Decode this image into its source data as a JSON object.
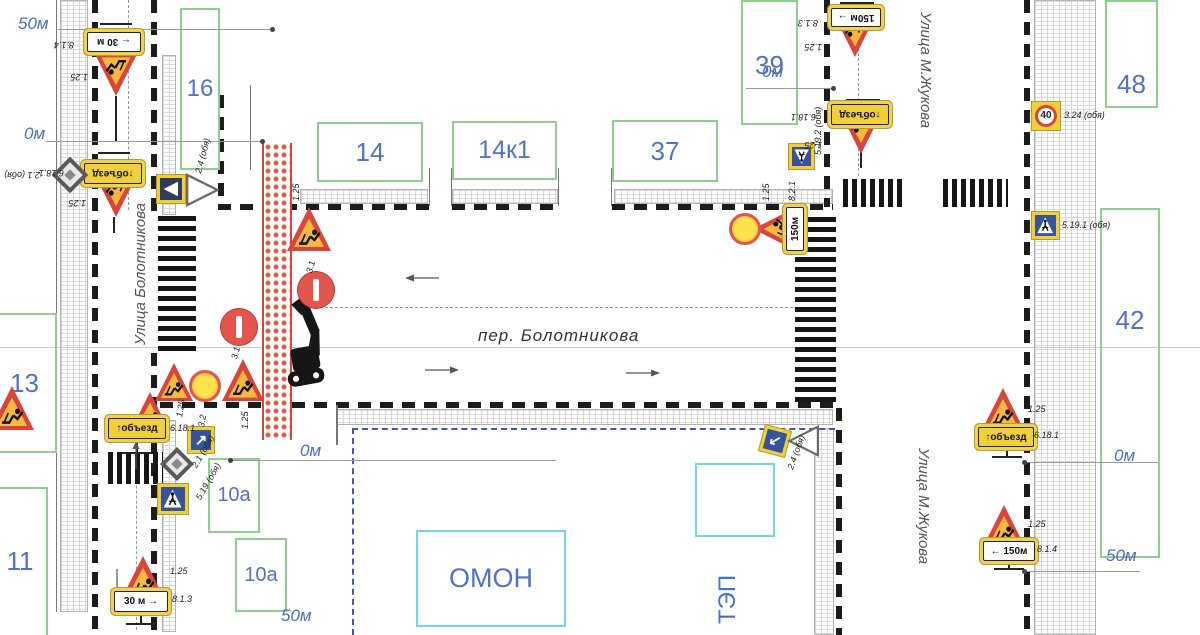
{
  "streets": {
    "left": "Улица Болотникова",
    "center": "пер. Болотникова",
    "right_top": "Улица М.Жукова",
    "right_bottom": "Улица М.Жукова"
  },
  "compounds": {
    "tep_label": "ТЭП"
  },
  "colors": {
    "accent_red": "#d9443b",
    "sign_yellow": "#f0cf3a",
    "building_green": "#8fce8f",
    "compound_cyan": "#74d4e8",
    "number_blue": "#5272c4",
    "marker_blue": "#4a6fc4"
  },
  "buildings": [
    {
      "label": "16",
      "x": 180,
      "y": 8,
      "w": 40,
      "h": 162,
      "fs": 24
    },
    {
      "label": "14",
      "x": 317,
      "y": 122,
      "w": 106,
      "h": 60,
      "fs": 26
    },
    {
      "label": "14к1",
      "x": 452,
      "y": 121,
      "w": 105,
      "h": 59,
      "fs": 25
    },
    {
      "label": "37",
      "x": 612,
      "y": 120,
      "w": 106,
      "h": 62,
      "fs": 26
    },
    {
      "label": "39",
      "x": 741,
      "y": 0,
      "w": 57,
      "h": 125,
      "fs": 26,
      "lp": 0.38
    },
    {
      "label": "48",
      "x": 1105,
      "y": 0,
      "w": 53,
      "h": 108,
      "fs": 26,
      "lp": 0.62
    },
    {
      "label": "42",
      "x": 1100,
      "y": 208,
      "w": 60,
      "h": 350,
      "fs": 26,
      "lp": 0.27
    },
    {
      "label": "13",
      "x": -8,
      "y": 313,
      "w": 65,
      "h": 140,
      "fs": 26
    },
    {
      "label": "11",
      "x": -8,
      "y": 487,
      "w": 56,
      "h": 150,
      "fs": 26,
      "lp": 0.38
    },
    {
      "label": "10а",
      "x": 208,
      "y": 458,
      "w": 52,
      "h": 75,
      "fs": 20
    },
    {
      "label": "10а",
      "x": 235,
      "y": 538,
      "w": 52,
      "h": 74,
      "fs": 20
    }
  ],
  "areas": [
    {
      "label": "ОМОН",
      "x": 416,
      "y": 530,
      "w": 150,
      "h": 97,
      "fs": 27
    },
    {
      "label": "",
      "x": 695,
      "y": 463,
      "w": 80,
      "h": 74,
      "fs": 0
    }
  ],
  "markers": [
    {
      "text": "50м",
      "x": 18,
      "y": 14,
      "line": [
        58,
        29,
        272,
        29
      ],
      "dot": [
        272,
        29
      ]
    },
    {
      "text": "0м",
      "x": 24,
      "y": 124,
      "line": [
        46,
        141,
        262,
        141
      ],
      "dot": [
        262,
        141
      ]
    },
    {
      "text": "0м",
      "x": 300,
      "y": 441,
      "line": [
        230,
        460,
        556,
        460
      ],
      "dot": [
        230,
        460
      ]
    },
    {
      "text": "0м",
      "x": 762,
      "y": 62,
      "line": [
        746,
        88,
        833,
        88
      ],
      "dot": [
        833,
        88
      ]
    },
    {
      "text": "0м",
      "x": 1114,
      "y": 446,
      "line": [
        1024,
        462,
        1158,
        462
      ],
      "dot": [
        1024,
        462
      ]
    },
    {
      "text": "50м",
      "x": 1106,
      "y": 546,
      "line": [
        1024,
        571,
        1140,
        571
      ],
      "dot": [
        1024,
        571
      ]
    },
    {
      "text": "50м",
      "x": 281,
      "y": 606,
      "line": null,
      "dot": null
    }
  ],
  "signs": [
    {
      "k": "tri",
      "x": 116,
      "y": 75,
      "s": 42,
      "r": 180
    },
    {
      "k": "tri",
      "x": 116,
      "y": 196,
      "s": 42,
      "r": 180
    },
    {
      "k": "tri",
      "x": 174,
      "y": 382,
      "s": 38,
      "r": 0
    },
    {
      "k": "tri",
      "x": 243,
      "y": 380,
      "s": 42,
      "r": 0
    },
    {
      "k": "tri",
      "x": 150,
      "y": 412,
      "s": 40,
      "r": 0
    },
    {
      "k": "tri",
      "x": 12,
      "y": 408,
      "s": 44,
      "r": 0
    },
    {
      "k": "tri",
      "x": 309,
      "y": 229,
      "s": 44,
      "r": 0
    },
    {
      "k": "tri",
      "x": 773,
      "y": 229,
      "s": 40,
      "r": -90
    },
    {
      "k": "tri",
      "x": 855,
      "y": 37,
      "s": 40,
      "r": 180
    },
    {
      "k": "tri",
      "x": 861,
      "y": 133,
      "s": 42,
      "r": 180
    },
    {
      "k": "tri",
      "x": 1003,
      "y": 409,
      "s": 42,
      "r": 0
    },
    {
      "k": "tri",
      "x": 1004,
      "y": 526,
      "s": 42,
      "r": 0
    },
    {
      "k": "tri",
      "x": 143,
      "y": 578,
      "s": 44,
      "r": 0
    },
    {
      "k": "noentry",
      "x": 239,
      "y": 327,
      "s": 36
    },
    {
      "k": "noentry",
      "x": 316,
      "y": 290,
      "s": 36
    },
    {
      "k": "signal",
      "x": 205,
      "y": 386,
      "s": 32
    },
    {
      "k": "signal",
      "x": 745,
      "y": 229,
      "s": 32
    },
    {
      "k": "plate",
      "x": 114,
      "y": 42,
      "w": 54,
      "h": 20,
      "r": 180,
      "text": "← 30 м",
      "bg": "w"
    },
    {
      "k": "plate",
      "x": 113,
      "y": 173,
      "w": 58,
      "h": 21,
      "r": 180,
      "text": "↑объезд",
      "bg": "y"
    },
    {
      "k": "plate",
      "x": 856,
      "y": 17,
      "w": 50,
      "h": 19,
      "r": 180,
      "text": "150м →",
      "bg": "w"
    },
    {
      "k": "plate",
      "x": 860,
      "y": 114,
      "w": 58,
      "h": 21,
      "r": 180,
      "text": "↑объезд",
      "bg": "y"
    },
    {
      "k": "plate",
      "x": 795,
      "y": 229,
      "w": 44,
      "h": 18,
      "r": -90,
      "text": "150м",
      "bg": "w"
    },
    {
      "k": "plate",
      "x": 137,
      "y": 428,
      "w": 58,
      "h": 21,
      "r": 0,
      "text": "↑объезд",
      "bg": "y"
    },
    {
      "k": "plate",
      "x": 141,
      "y": 601,
      "w": 54,
      "h": 21,
      "r": 0,
      "text": "30 м →",
      "bg": "w"
    },
    {
      "k": "plate",
      "x": 1006,
      "y": 437,
      "w": 56,
      "h": 20,
      "r": 0,
      "text": "↑объезд",
      "bg": "y"
    },
    {
      "k": "plate",
      "x": 1009,
      "y": 551,
      "w": 52,
      "h": 20,
      "r": 0,
      "text": "← 150м",
      "bg": "w"
    },
    {
      "k": "cross",
      "x": 173,
      "y": 499,
      "s": 32,
      "r": 0
    },
    {
      "k": "cross",
      "x": 801,
      "y": 156,
      "s": 27,
      "r": 180
    },
    {
      "k": "cross",
      "x": 1045,
      "y": 225,
      "s": 29,
      "r": 0
    },
    {
      "k": "s40",
      "x": 1046,
      "y": 116,
      "s": 30,
      "text": "40"
    },
    {
      "k": "diam",
      "x": 177,
      "y": 464,
      "s": 24
    },
    {
      "k": "diam",
      "x": 70,
      "y": 175,
      "s": 26
    },
    {
      "k": "arr",
      "x": 201,
      "y": 440,
      "s": 28,
      "r": 0
    },
    {
      "k": "arr",
      "x": 775,
      "y": 441,
      "s": 28,
      "r": 195
    },
    {
      "k": "gw",
      "x": 203,
      "y": 190,
      "s": 34,
      "r": 90
    },
    {
      "k": "gw",
      "x": 803,
      "y": 441,
      "s": 32,
      "r": -90
    },
    {
      "k": "gwf",
      "x": 171,
      "y": 189,
      "s": 30,
      "r": 0
    }
  ],
  "labels": [
    {
      "t": "8.1.4",
      "x": 74,
      "y": 40,
      "r": 180
    },
    {
      "t": "1.25",
      "x": 88,
      "y": 72,
      "r": 180
    },
    {
      "t": "2.1 (обя)",
      "x": 40,
      "y": 170,
      "r": 180
    },
    {
      "t": "6.18.1",
      "x": 64,
      "y": 168,
      "r": 180
    },
    {
      "t": "1.25",
      "x": 86,
      "y": 198,
      "r": 180
    },
    {
      "t": "2.4 (обя)",
      "x": 198,
      "y": 168,
      "r": -75
    },
    {
      "t": "1.25",
      "x": 296,
      "y": 196,
      "r": -90
    },
    {
      "t": "3.1",
      "x": 234,
      "y": 354,
      "r": -75
    },
    {
      "t": "3.1",
      "x": 309,
      "y": 268,
      "r": -75
    },
    {
      "t": "1.25",
      "x": 179,
      "y": 412,
      "r": -80
    },
    {
      "t": "3.2",
      "x": 201,
      "y": 422,
      "r": -80
    },
    {
      "t": "1.25",
      "x": 245,
      "y": 424,
      "r": -90
    },
    {
      "t": "6.18.1",
      "x": 170,
      "y": 423,
      "r": 0
    },
    {
      "t": "5.19 (обя)",
      "x": 198,
      "y": 494,
      "r": -60
    },
    {
      "t": "2.1 (обя)",
      "x": 194,
      "y": 462,
      "r": -60
    },
    {
      "t": "1.25",
      "x": 170,
      "y": 566,
      "r": 0
    },
    {
      "t": "8.1.3",
      "x": 172,
      "y": 594,
      "r": 0
    },
    {
      "t": "8.1.3",
      "x": 818,
      "y": 18,
      "r": 180
    },
    {
      "t": "1.25",
      "x": 822,
      "y": 42,
      "r": 180
    },
    {
      "t": "6.18.1",
      "x": 816,
      "y": 112,
      "r": 180
    },
    {
      "t": "1.25",
      "x": 822,
      "y": 140,
      "r": 180
    },
    {
      "t": "5.19.2 (обя)",
      "x": 818,
      "y": 150,
      "r": -90
    },
    {
      "t": "1.25",
      "x": 766,
      "y": 196,
      "r": -90
    },
    {
      "t": "8.2.1",
      "x": 792,
      "y": 196,
      "r": -90
    },
    {
      "t": "3.24 (обя)",
      "x": 1064,
      "y": 110,
      "r": 0
    },
    {
      "t": "5.19.1 (обя)",
      "x": 1062,
      "y": 220,
      "r": 0
    },
    {
      "t": "1.25",
      "x": 1028,
      "y": 404,
      "r": 0
    },
    {
      "t": "6.18.1",
      "x": 1034,
      "y": 430,
      "r": 0
    },
    {
      "t": "1.25",
      "x": 1028,
      "y": 519,
      "r": 0
    },
    {
      "t": "8.1.4",
      "x": 1037,
      "y": 544,
      "r": 0
    },
    {
      "t": "2.4 (обя)",
      "x": 790,
      "y": 464,
      "r": -70
    }
  ],
  "zebras": [
    {
      "x": 158,
      "y": 216,
      "w": 38,
      "h": 138,
      "dir": "h"
    },
    {
      "x": 795,
      "y": 217,
      "w": 41,
      "h": 185,
      "dir": "h"
    },
    {
      "x": 108,
      "y": 452,
      "w": 55,
      "h": 32,
      "dir": "v"
    },
    {
      "x": 843,
      "y": 179,
      "w": 63,
      "h": 28,
      "dir": "v"
    },
    {
      "x": 943,
      "y": 179,
      "w": 65,
      "h": 28,
      "dir": "v"
    }
  ],
  "edges": [
    {
      "x": 92,
      "y": 0,
      "len": 635,
      "dir": "v"
    },
    {
      "x": 151,
      "y": 0,
      "len": 217,
      "dir": "v"
    },
    {
      "x": 151,
      "y": 353,
      "len": 282,
      "dir": "v"
    },
    {
      "x": 218,
      "y": 95,
      "len": 112,
      "dir": "v"
    },
    {
      "x": 218,
      "y": 204,
      "len": 212,
      "dir": "h"
    },
    {
      "x": 452,
      "y": 204,
      "len": 106,
      "dir": "h"
    },
    {
      "x": 612,
      "y": 204,
      "len": 221,
      "dir": "h"
    },
    {
      "x": 160,
      "y": 402,
      "len": 675,
      "dir": "h"
    },
    {
      "x": 824,
      "y": 0,
      "len": 207,
      "dir": "v"
    },
    {
      "x": 1024,
      "y": 0,
      "len": 635,
      "dir": "v"
    },
    {
      "x": 836,
      "y": 408,
      "len": 227,
      "dir": "v"
    }
  ],
  "hatches": [
    {
      "x": 60,
      "y": 0,
      "w": 28,
      "h": 612
    },
    {
      "x": 162,
      "y": 55,
      "w": 14,
      "h": 160
    },
    {
      "x": 300,
      "y": 189,
      "w": 128,
      "h": 15
    },
    {
      "x": 452,
      "y": 189,
      "w": 106,
      "h": 15
    },
    {
      "x": 614,
      "y": 189,
      "w": 219,
      "h": 15
    },
    {
      "x": 336,
      "y": 409,
      "w": 497,
      "h": 16
    },
    {
      "x": 1034,
      "y": 0,
      "w": 62,
      "h": 635
    },
    {
      "x": 814,
      "y": 428,
      "w": 20,
      "h": 207
    },
    {
      "x": 162,
      "y": 420,
      "w": 14,
      "h": 212
    }
  ],
  "guides": [
    {
      "x": 128,
      "y": 0,
      "len": 210,
      "dir": "v"
    },
    {
      "x": 136,
      "y": 430,
      "len": 200,
      "dir": "v"
    },
    {
      "x": 300,
      "y": 307,
      "len": 533,
      "dir": "h"
    },
    {
      "x": 858,
      "y": 8,
      "len": 168,
      "dir": "v"
    }
  ],
  "fences": [
    {
      "x": 352,
      "y": 428,
      "len": 483,
      "dir": "h"
    },
    {
      "x": 352,
      "y": 428,
      "len": 207,
      "dir": "v"
    }
  ],
  "walls": [
    {
      "x": 56,
      "y": 0,
      "w": 1,
      "h": 612
    },
    {
      "x": 250,
      "y": 85,
      "w": 1,
      "h": 85
    },
    {
      "x": 429,
      "y": 168,
      "w": 1,
      "h": 38
    },
    {
      "x": 451,
      "y": 168,
      "w": 1,
      "h": 38
    },
    {
      "x": 558,
      "y": 168,
      "w": 1,
      "h": 38
    },
    {
      "x": 611,
      "y": 168,
      "w": 1,
      "h": 38
    },
    {
      "x": 336,
      "y": 405,
      "w": 2,
      "h": 40
    }
  ],
  "poles": [
    {
      "x": 115,
      "y": 96,
      "w": 2,
      "h": 46
    },
    {
      "x": 100,
      "y": 23,
      "w": 32,
      "h": 2
    },
    {
      "x": 113,
      "y": 217,
      "w": 2,
      "h": 16
    },
    {
      "x": 98,
      "y": 152,
      "w": 32,
      "h": 2
    },
    {
      "x": 136,
      "y": 438,
      "w": 2,
      "h": 14
    },
    {
      "x": 122,
      "y": 452,
      "w": 30,
      "h": 2
    },
    {
      "x": 140,
      "y": 611,
      "w": 2,
      "h": 13
    },
    {
      "x": 126,
      "y": 623,
      "w": 30,
      "h": 2
    },
    {
      "x": 1006,
      "y": 446,
      "w": 2,
      "h": 12
    },
    {
      "x": 992,
      "y": 456,
      "w": 30,
      "h": 2
    },
    {
      "x": 1008,
      "y": 560,
      "w": 2,
      "h": 10
    },
    {
      "x": 994,
      "y": 568,
      "w": 30,
      "h": 2
    },
    {
      "x": 840,
      "y": 2,
      "w": 34,
      "h": 2
    },
    {
      "x": 846,
      "y": 99,
      "w": 34,
      "h": 2
    },
    {
      "x": 860,
      "y": 152,
      "w": 2,
      "h": 16
    }
  ],
  "arrows": [
    {
      "x": 404,
      "y": 270,
      "dir": "left"
    },
    {
      "x": 424,
      "y": 362,
      "dir": "right"
    },
    {
      "x": 625,
      "y": 365,
      "dir": "right"
    },
    {
      "x": 131,
      "y": 440,
      "dir": "up"
    },
    {
      "x": 112,
      "y": 568,
      "dir": "down"
    }
  ],
  "closure": {
    "x": 262,
    "y": 143,
    "w": 30,
    "h": 297
  },
  "excavator": {
    "x": 262,
    "y": 298,
    "w": 72,
    "h": 102,
    "r": -10
  },
  "axis": {
    "y": 347
  }
}
